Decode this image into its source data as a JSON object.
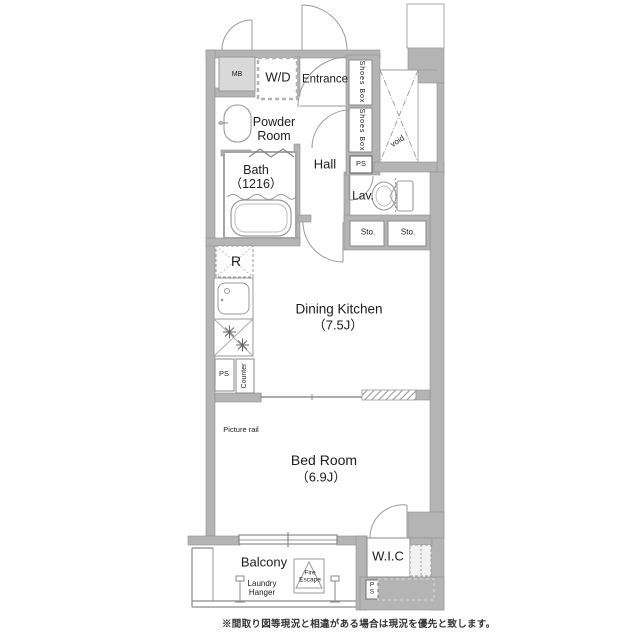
{
  "floorplan": {
    "rooms": {
      "entrance": "Entrance",
      "hall": "Hall",
      "powder_room": [
        "Powder",
        "Room"
      ],
      "bath": [
        "Bath",
        "（1216）"
      ],
      "lavatory": "Lav.",
      "dining_kitchen": [
        "Dining Kitchen",
        "（7.5J）"
      ],
      "bed_room": [
        "Bed Room",
        "（6.9J）"
      ],
      "wic": "W.I.C",
      "balcony": "Balcony"
    },
    "fixtures": {
      "mb": "MB",
      "wd": "W/D",
      "shoes_box_1": "Shoes Box",
      "shoes_box_2": "Shoes Box",
      "ps_entry": "PS",
      "void": "void",
      "sto_1": "Sto.",
      "sto_2": "Sto.",
      "fridge": "R",
      "ps_kitchen": "PS",
      "counter": "Counter",
      "picture_rail": "Picture rail",
      "ps_bottom": [
        "P",
        "S"
      ],
      "laundry_hanger": [
        "Laundry",
        "Hanger"
      ],
      "fire_escape": [
        "Fire",
        "Escape"
      ]
    },
    "note": "※間取り図等現況と相違がある場合は現況を優先と致します。",
    "colors": {
      "wall": "#b4b4b4",
      "line": "#9a9a9a",
      "text": "#1c1c1c"
    }
  }
}
